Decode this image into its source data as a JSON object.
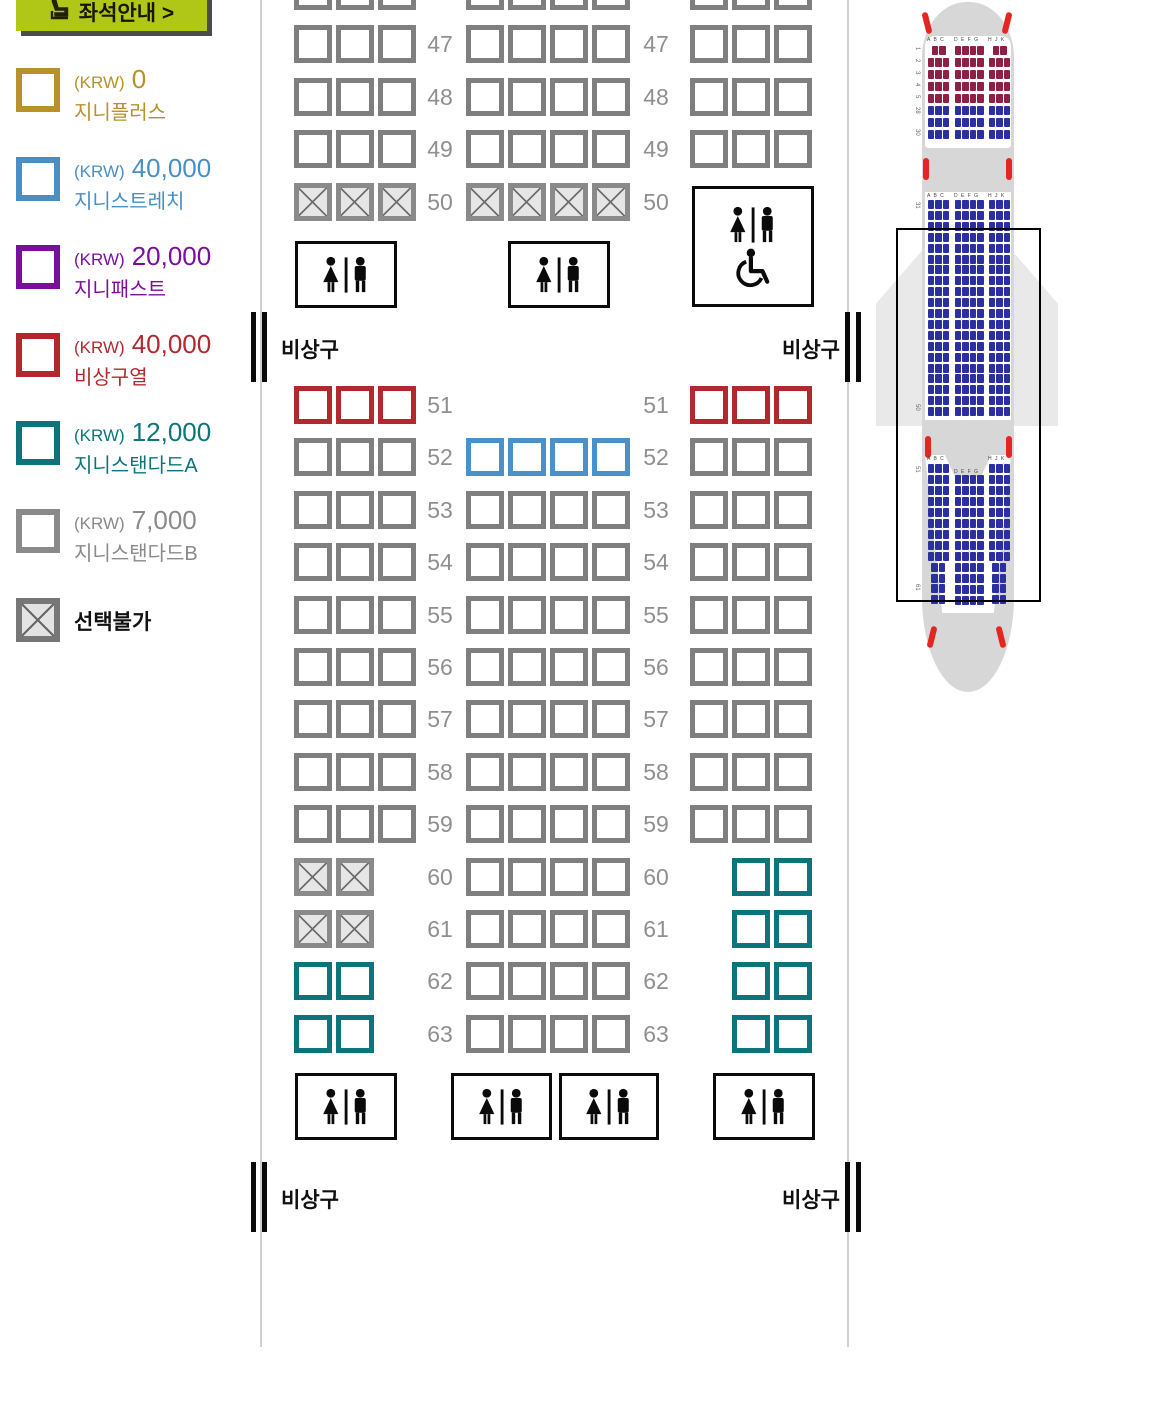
{
  "legend": {
    "guide_button": {
      "label": "좌석안내 >"
    },
    "items": [
      {
        "currency": "(KRW)",
        "price": "0",
        "name": "지니플러스",
        "color": "#b8912b",
        "blocked": false
      },
      {
        "currency": "(KRW)",
        "price": "40,000",
        "name": "지니스트레치",
        "color": "#4a8fc4",
        "blocked": false
      },
      {
        "currency": "(KRW)",
        "price": "20,000",
        "name": "지니패스트",
        "color": "#7a0f9d",
        "blocked": false
      },
      {
        "currency": "(KRW)",
        "price": "40,000",
        "name": "비상구열",
        "color": "#b2282d",
        "blocked": false
      },
      {
        "currency": "(KRW)",
        "price": "12,000",
        "name": "지니스탠다드A",
        "color": "#0c757b",
        "blocked": false
      },
      {
        "currency": "(KRW)",
        "price": "7,000",
        "name": "지니스탠다드B",
        "color": "#8a8a8a",
        "blocked": false
      },
      {
        "currency": "",
        "price": "",
        "name": "선택불가",
        "color": "#111111",
        "blocked": true
      }
    ]
  },
  "seatmap": {
    "exit_label": "비상구",
    "rows": [
      {
        "num": "46",
        "top": -28,
        "left": [
          "st",
          "st",
          "st"
        ],
        "mid": [
          "st",
          "st",
          "st",
          "st"
        ],
        "right": [
          "st",
          "st",
          "st"
        ]
      },
      {
        "num": "47",
        "top": 25,
        "left": [
          "st",
          "st",
          "st"
        ],
        "mid": [
          "st",
          "st",
          "st",
          "st"
        ],
        "right": [
          "st",
          "st",
          "st"
        ]
      },
      {
        "num": "48",
        "top": 78,
        "left": [
          "st",
          "st",
          "st"
        ],
        "mid": [
          "st",
          "st",
          "st",
          "st"
        ],
        "right": [
          "st",
          "st",
          "st"
        ]
      },
      {
        "num": "49",
        "top": 130,
        "left": [
          "st",
          "st",
          "st"
        ],
        "mid": [
          "st",
          "st",
          "st",
          "st"
        ],
        "right": [
          "st",
          "st",
          "st"
        ]
      },
      {
        "num": "50",
        "top": 183,
        "left": [
          "x",
          "x",
          "x"
        ],
        "mid": [
          "x",
          "x",
          "x",
          "x"
        ],
        "right": []
      },
      {
        "num": "51",
        "top": 386,
        "left": [
          "exit",
          "exit",
          "exit"
        ],
        "mid": [],
        "right": [
          "exit",
          "exit",
          "exit"
        ]
      },
      {
        "num": "52",
        "top": 438,
        "left": [
          "st",
          "st",
          "st"
        ],
        "mid": [
          "stretch",
          "stretch",
          "stretch",
          "stretch"
        ],
        "right": [
          "st",
          "st",
          "st"
        ]
      },
      {
        "num": "53",
        "top": 491,
        "left": [
          "st",
          "st",
          "st"
        ],
        "mid": [
          "st",
          "st",
          "st",
          "st"
        ],
        "right": [
          "st",
          "st",
          "st"
        ]
      },
      {
        "num": "54",
        "top": 543,
        "left": [
          "st",
          "st",
          "st"
        ],
        "mid": [
          "st",
          "st",
          "st",
          "st"
        ],
        "right": [
          "st",
          "st",
          "st"
        ]
      },
      {
        "num": "55",
        "top": 596,
        "left": [
          "st",
          "st",
          "st"
        ],
        "mid": [
          "st",
          "st",
          "st",
          "st"
        ],
        "right": [
          "st",
          "st",
          "st"
        ]
      },
      {
        "num": "56",
        "top": 648,
        "left": [
          "st",
          "st",
          "st"
        ],
        "mid": [
          "st",
          "st",
          "st",
          "st"
        ],
        "right": [
          "st",
          "st",
          "st"
        ]
      },
      {
        "num": "57",
        "top": 700,
        "left": [
          "st",
          "st",
          "st"
        ],
        "mid": [
          "st",
          "st",
          "st",
          "st"
        ],
        "right": [
          "st",
          "st",
          "st"
        ]
      },
      {
        "num": "58",
        "top": 753,
        "left": [
          "st",
          "st",
          "st"
        ],
        "mid": [
          "st",
          "st",
          "st",
          "st"
        ],
        "right": [
          "st",
          "st",
          "st"
        ]
      },
      {
        "num": "59",
        "top": 805,
        "left": [
          "st",
          "st",
          "st"
        ],
        "mid": [
          "st",
          "st",
          "st",
          "st"
        ],
        "right": [
          "st",
          "st",
          "st"
        ]
      },
      {
        "num": "60",
        "top": 858,
        "left": [
          "x",
          "x"
        ],
        "mid": [
          "st",
          "st",
          "st",
          "st"
        ],
        "right": [
          "stdA",
          "stdA"
        ],
        "ra": true
      },
      {
        "num": "61",
        "top": 910,
        "left": [
          "x",
          "x"
        ],
        "mid": [
          "st",
          "st",
          "st",
          "st"
        ],
        "right": [
          "stdA",
          "stdA"
        ],
        "ra": true
      },
      {
        "num": "62",
        "top": 962,
        "left": [
          "stdA",
          "stdA"
        ],
        "mid": [
          "st",
          "st",
          "st",
          "st"
        ],
        "right": [
          "stdA",
          "stdA"
        ],
        "ra": true
      },
      {
        "num": "63",
        "top": 1015,
        "left": [
          "stdA",
          "stdA"
        ],
        "mid": [
          "st",
          "st",
          "st",
          "st"
        ],
        "right": [
          "stdA",
          "stdA"
        ],
        "ra": true
      }
    ],
    "lavatories": [
      {
        "x": 295,
        "y": 241,
        "w": 102,
        "h": 67,
        "type": "wc"
      },
      {
        "x": 508,
        "y": 241,
        "w": 102,
        "h": 67,
        "type": "wc"
      },
      {
        "x": 692,
        "y": 186,
        "w": 122,
        "h": 121,
        "type": "wc_accessible"
      },
      {
        "x": 295,
        "y": 1073,
        "w": 102,
        "h": 67,
        "type": "wc"
      },
      {
        "x": 451,
        "y": 1073,
        "w": 101,
        "h": 67,
        "type": "wc"
      },
      {
        "x": 559,
        "y": 1073,
        "w": 100,
        "h": 67,
        "type": "wc"
      },
      {
        "x": 713,
        "y": 1073,
        "w": 102,
        "h": 67,
        "type": "wc"
      }
    ],
    "exit_bands": [
      {
        "y": 312
      },
      {
        "y": 1162
      }
    ]
  },
  "minimap": {
    "letters": [
      "A B C",
      "D E F G",
      "H J K"
    ],
    "row_labels": {
      "forward": [
        "1",
        "2",
        "3",
        "4",
        "5",
        "28",
        "30"
      ],
      "mid": [
        "31",
        "50"
      ],
      "aft": [
        "51",
        "61"
      ]
    },
    "colors": {
      "business": "#8f2045",
      "economy": "#2b2fa0",
      "door": "#e52620",
      "fuselage": "#d7d7d7",
      "wing": "#e9e9e9"
    },
    "forward_rows": [
      [
        2,
        4,
        2,
        "business"
      ],
      [
        3,
        4,
        3,
        "business"
      ],
      [
        3,
        4,
        3,
        "business"
      ],
      [
        3,
        4,
        3,
        "business"
      ],
      [
        3,
        4,
        3,
        "business"
      ],
      [
        3,
        4,
        3,
        "economy"
      ],
      [
        3,
        4,
        3,
        "economy"
      ],
      [
        3,
        4,
        3,
        "economy"
      ]
    ],
    "mid_rows": 20,
    "aft_side_rows": 9,
    "aft_narrow_rows": 4,
    "aft_mid_rows": 12
  }
}
